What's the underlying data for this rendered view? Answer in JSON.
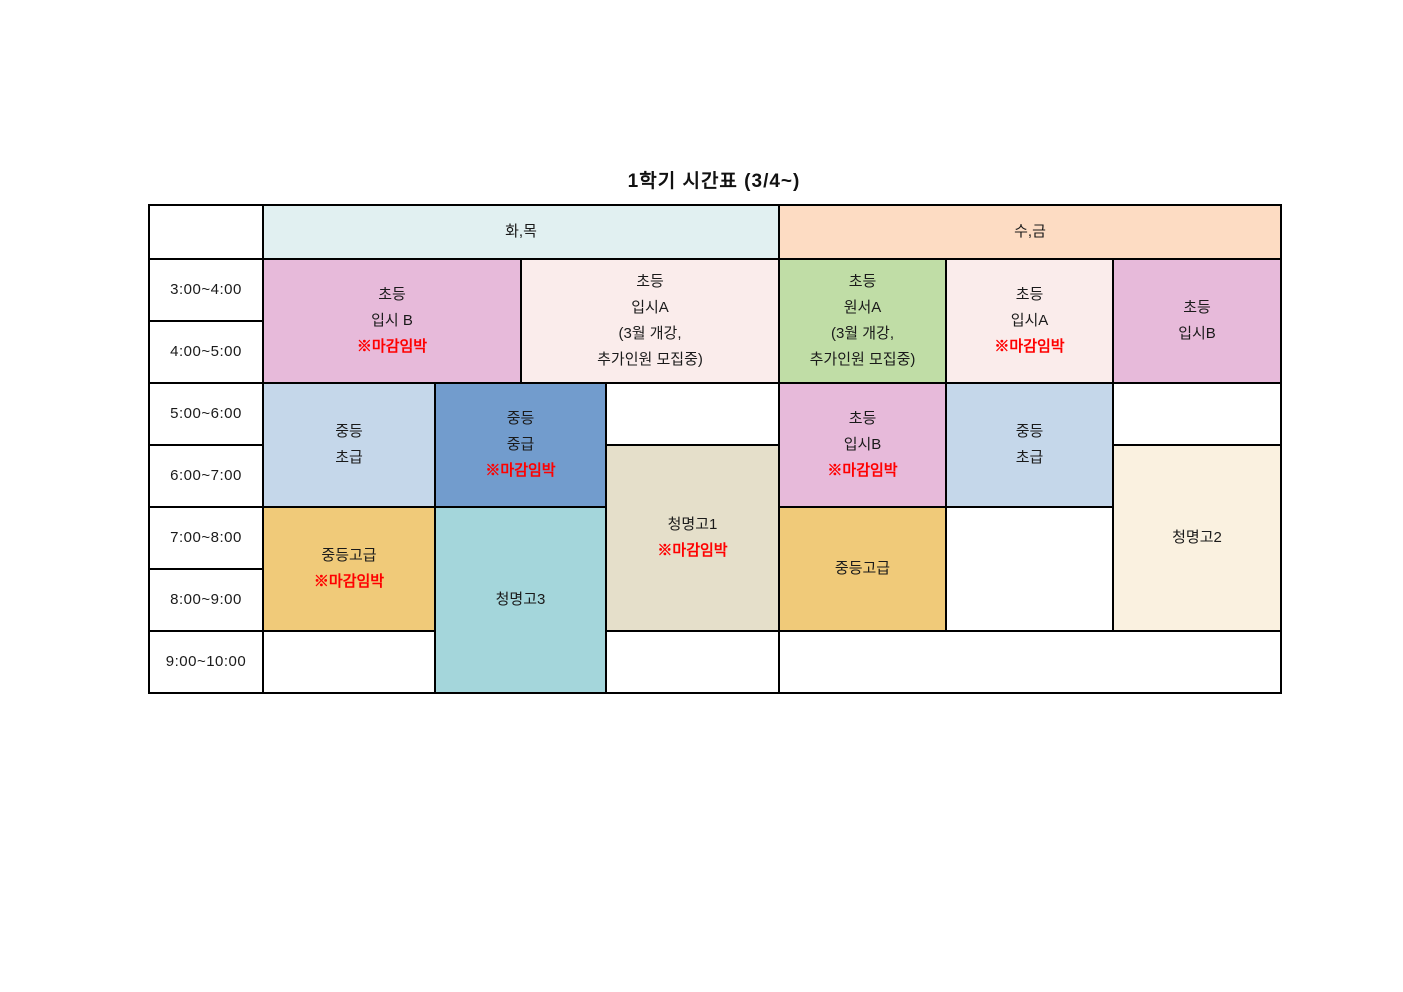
{
  "title": "1학기 시간표 (3/4~)",
  "day_headers": {
    "tue_thu": "화,목",
    "wed_fri": "수,금"
  },
  "time_slots": [
    "3:00~4:00",
    "4:00~5:00",
    "5:00~6:00",
    "6:00~7:00",
    "7:00~8:00",
    "8:00~9:00",
    "9:00~10:00"
  ],
  "urgent_label": "※마감임박",
  "classes": {
    "tt_elem_ipsi_b": {
      "lines": [
        "초등",
        "입시 B"
      ],
      "urgent": "※마감임박",
      "days": "화,목",
      "time": "3:00~5:00"
    },
    "tt_elem_ipsi_a": {
      "lines": [
        "초등",
        "입시A",
        "(3월 개강,",
        "추가인원 모집중)"
      ],
      "days": "화,목",
      "time": "3:00~5:00"
    },
    "tt_mid_beginner": {
      "lines": [
        "중등",
        "초급"
      ],
      "days": "화,목",
      "time": "5:00~7:00"
    },
    "tt_mid_intermediate": {
      "lines": [
        "중등",
        "중급"
      ],
      "urgent": "※마감임박",
      "days": "화,목",
      "time": "5:00~7:00"
    },
    "tt_cheongmyeong1": {
      "lines": [
        "청명고1"
      ],
      "urgent": "※마감임박",
      "days": "화,목",
      "time": "6:00~9:00"
    },
    "tt_mid_advanced": {
      "lines": [
        "중등고급"
      ],
      "urgent": "※마감임박",
      "days": "화,목",
      "time": "7:00~9:00"
    },
    "tt_cheongmyeong3": {
      "lines": [
        "청명고3"
      ],
      "days": "화,목",
      "time": "7:00~10:00"
    },
    "wf_elem_wonseo_a": {
      "lines": [
        "초등",
        "원서A",
        "(3월 개강,",
        "추가인원 모집중)"
      ],
      "days": "수,금",
      "time": "3:00~5:00"
    },
    "wf_elem_ipsi_a": {
      "lines": [
        "초등",
        "입시A"
      ],
      "urgent": "※마감임박",
      "days": "수,금",
      "time": "3:00~5:00"
    },
    "wf_elem_ipsi_b_top": {
      "lines": [
        "초등",
        "입시B"
      ],
      "days": "수,금",
      "time": "3:00~5:00"
    },
    "wf_elem_ipsi_b": {
      "lines": [
        "초등",
        "입시B"
      ],
      "urgent": "※마감임박",
      "days": "수,금",
      "time": "5:00~7:00"
    },
    "wf_mid_beginner": {
      "lines": [
        "중등",
        "초급"
      ],
      "days": "수,금",
      "time": "5:00~7:00"
    },
    "wf_cheongmyeong2": {
      "lines": [
        "청명고2"
      ],
      "days": "수,금",
      "time": "6:00~9:00"
    },
    "wf_mid_advanced": {
      "lines": [
        "중등고급"
      ],
      "days": "수,금",
      "time": "7:00~9:00"
    }
  },
  "colors": {
    "header_tue_thu": "#e1f0f1",
    "header_wed_fri": "#fddcc3",
    "pink": "#e7bada",
    "pale_pink": "#faeceb",
    "green": "#c0dda6",
    "light_blue": "#c5d7ea",
    "blue": "#729ccd",
    "beige": "#e5dfca",
    "cream": "#faf1e0",
    "orange": "#f0ca79",
    "teal": "#a4d6db",
    "urgent_red": "#ff0000"
  }
}
